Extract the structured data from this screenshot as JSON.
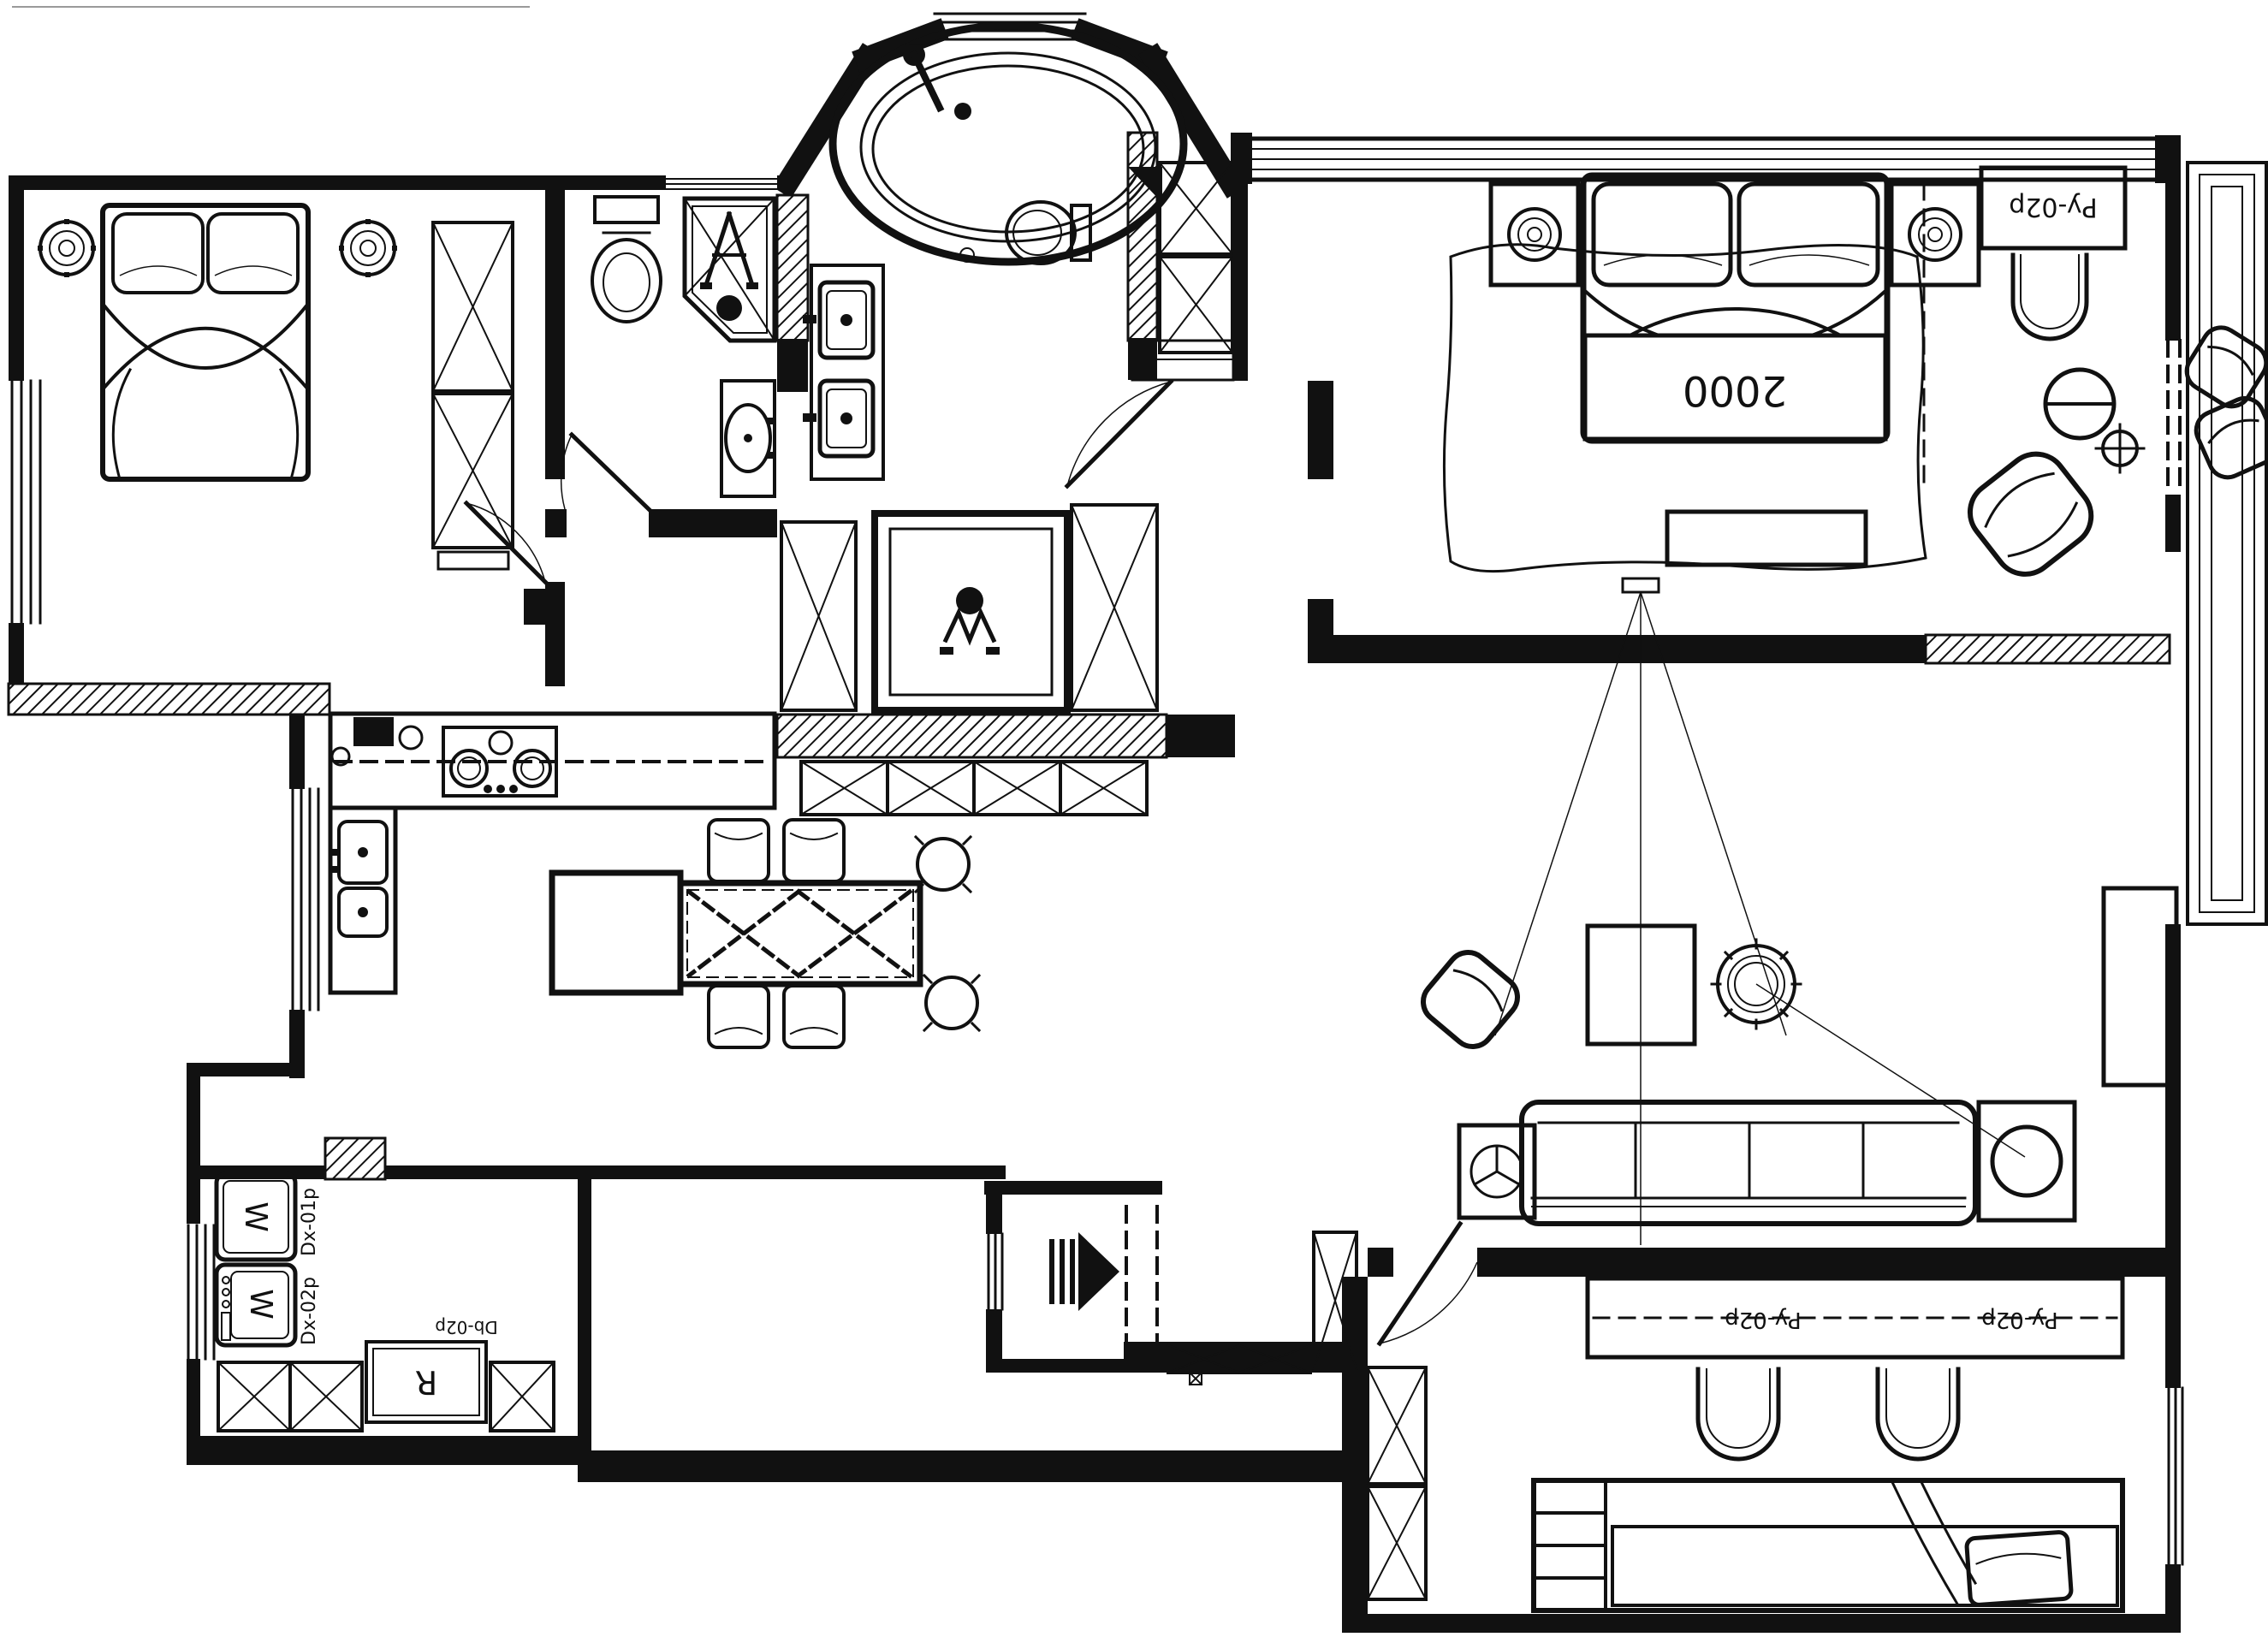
{
  "drawing": {
    "kind": "apartment-floor-plan",
    "paper_color": "#ffffff",
    "ink_color": "#111111"
  },
  "labels": {
    "master_bed_width": "2000",
    "master_cabinet_code": "Py-02p",
    "kids_desk_left_code": "Py-02p",
    "kids_desk_right_code": "Py-02p",
    "washer_top_letter": "W",
    "washer_bottom_letter": "W",
    "washer_top_code": "Dx-01p",
    "washer_bottom_code": "Dx-02p",
    "laundry_cabinet_code": "Db-02p",
    "laundry_cabinet_letter": "R"
  }
}
